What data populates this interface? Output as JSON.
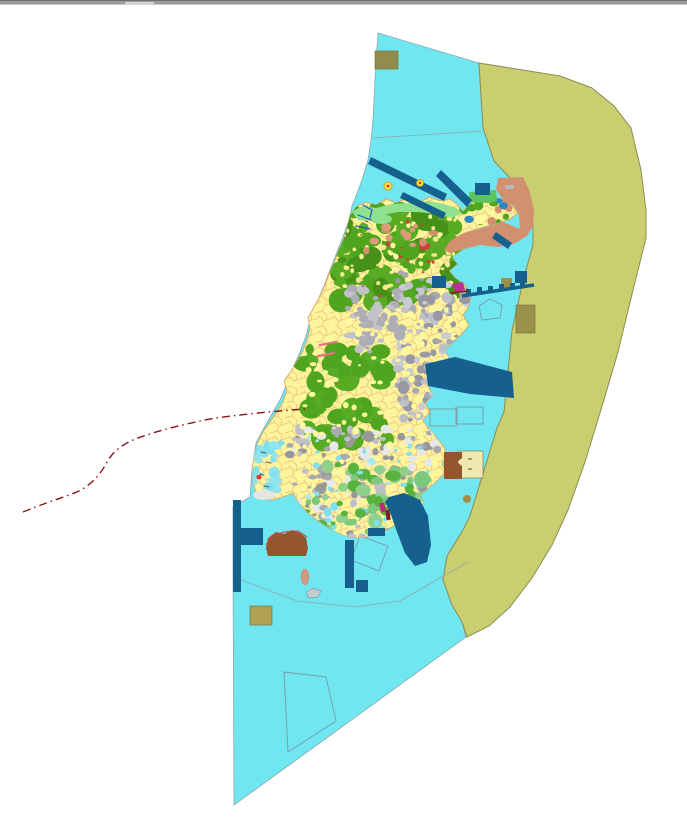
{
  "window": {
    "top_bar": {
      "role": "window-edge",
      "handle": "drag-handle"
    }
  },
  "palette": {
    "background": "#FFFFFF",
    "coastal_zone": "#70E6F0",
    "coastal_outline": "#88A8B0",
    "offshore_zone": "#C9CF6E",
    "offshore_outline": "#8C8C55",
    "island_base": "#FDF49B",
    "island_outline": "#D9A05B",
    "parcel_line": "#E9C482",
    "shore_green": "#8FE08F",
    "ne_green_strip": "#5CC45C",
    "salmon": "#D2906F",
    "marine_blue": "#15608D",
    "dark_olive_a": "#8F8C4D",
    "dark_olive_b": "#9A914B",
    "dark_olive_c": "#B0A050",
    "olive_dot": "#9F8F45",
    "brown_fill": "#94552D",
    "pale_panel": "#EFE9B0",
    "magenta_mark": "#C03090",
    "port_magenta": "#A02070",
    "red_route": "#8B1515",
    "red_mark": "#D04040",
    "salmon_oval": "#D89878",
    "islet_gray": "#C4CCD0",
    "pale_blob": "#E4E4E0",
    "marker_yellow": "#FFE94A",
    "marker_ring": "#C8A020"
  },
  "map": {
    "regions": [
      {
        "name": "coastal-planning-zone",
        "color": "#70E6F0"
      },
      {
        "name": "offshore-eastern-zone",
        "color": "#C9CF6E"
      },
      {
        "name": "island-landuse-area",
        "color": "#FDF49B"
      }
    ],
    "route": {
      "name": "red-dashed-route",
      "color": "#8B1515",
      "style": "dash-dot"
    },
    "texture_regions": [
      {
        "name": "north-forest",
        "x": 336,
        "y": 206,
        "w": 126,
        "h": 96,
        "count": 95,
        "min": 4,
        "max": 13,
        "colors": [
          "#4FA51E",
          "#58AC24",
          "#469219"
        ]
      },
      {
        "name": "north-veins",
        "x": 340,
        "y": 210,
        "w": 118,
        "h": 88,
        "count": 70,
        "min": 1.5,
        "max": 3,
        "colors": [
          "#FFF9A0",
          "#F6E98C"
        ]
      },
      {
        "name": "ne-peninsula",
        "x": 462,
        "y": 198,
        "w": 52,
        "h": 26,
        "count": 26,
        "min": 2,
        "max": 5,
        "colors": [
          "#4FA51E",
          "#FFF9A0",
          "#D2906F",
          "#2E86C1"
        ]
      },
      {
        "name": "mid-forest",
        "x": 304,
        "y": 348,
        "w": 86,
        "h": 92,
        "count": 60,
        "min": 4,
        "max": 12,
        "colors": [
          "#4FA51E",
          "#58AC24"
        ]
      },
      {
        "name": "mid-urban",
        "x": 348,
        "y": 288,
        "w": 66,
        "h": 66,
        "count": 55,
        "min": 2.5,
        "max": 6,
        "colors": [
          "#ADADB5",
          "#C2C2CA"
        ]
      },
      {
        "name": "east-urban",
        "x": 394,
        "y": 272,
        "w": 78,
        "h": 150,
        "count": 130,
        "min": 2,
        "max": 6,
        "colors": [
          "#A9A9B2",
          "#BFBFC8",
          "#9898A2",
          "#CACAD2"
        ]
      },
      {
        "name": "south-urban",
        "x": 288,
        "y": 428,
        "w": 150,
        "h": 112,
        "count": 170,
        "min": 2,
        "max": 6,
        "colors": [
          "#A9A9B2",
          "#BFBFC8",
          "#989898",
          "#E8E8E8"
        ]
      },
      {
        "name": "south-yellow",
        "x": 292,
        "y": 300,
        "w": 176,
        "h": 236,
        "count": 150,
        "min": 1.5,
        "max": 3.5,
        "colors": [
          "#FFFB9C",
          "#FFF6A0"
        ]
      },
      {
        "name": "south-parks",
        "x": 322,
        "y": 462,
        "w": 104,
        "h": 68,
        "count": 45,
        "min": 3,
        "max": 8,
        "colors": [
          "#7CC87C",
          "#8FD08A",
          "#58B23E"
        ]
      },
      {
        "name": "south-water-flecks",
        "x": 300,
        "y": 436,
        "w": 142,
        "h": 98,
        "count": 42,
        "min": 1.5,
        "max": 4,
        "colors": [
          "#7FE0EE",
          "#A5E9F2"
        ]
      },
      {
        "name": "west-lagoon",
        "x": 252,
        "y": 440,
        "w": 30,
        "h": 64,
        "count": 26,
        "min": 2,
        "max": 6,
        "colors": [
          "#7FE0EE",
          "#8FE4F0"
        ]
      },
      {
        "name": "north-salmon-bits",
        "x": 366,
        "y": 224,
        "w": 72,
        "h": 30,
        "count": 14,
        "min": 2.5,
        "max": 6,
        "colors": [
          "#D2906F",
          "#DC9A7A",
          "#D04040"
        ]
      },
      {
        "name": "red-specks",
        "x": 336,
        "y": 214,
        "w": 120,
        "h": 90,
        "count": 16,
        "min": 1,
        "max": 2.2,
        "colors": [
          "#D04040"
        ]
      },
      {
        "name": "coast-green-south",
        "x": 300,
        "y": 500,
        "w": 140,
        "h": 32,
        "count": 24,
        "min": 2,
        "max": 6,
        "colors": [
          "#7CC87C",
          "#58B23E"
        ]
      }
    ]
  }
}
